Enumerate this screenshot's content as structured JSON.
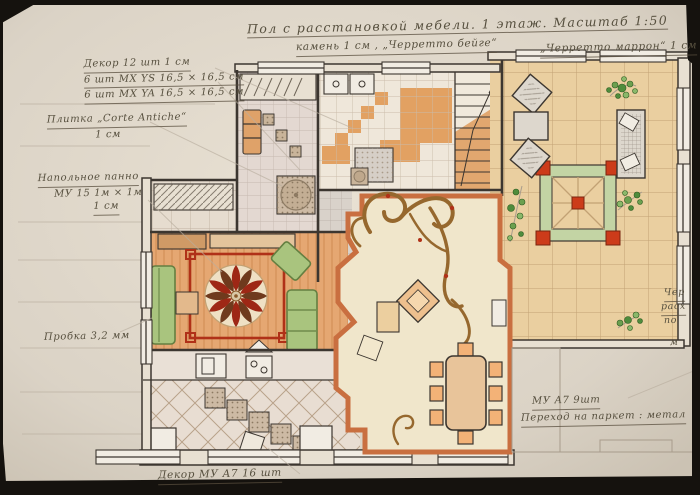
{
  "title": {
    "main": "Пол с расстановкой мебели. 1 этаж. Масштаб 1:50",
    "sub_left": "камень 1 см , „Черретто бейге“",
    "sub_right": "„Черретто маррон“ 1 см"
  },
  "notes": {
    "decor_line1": "Декор 12 шт   1 см",
    "decor_line2": "6 шт MX YS   16,5 × 16,5 см",
    "decor_line3": "6 шт MX YA   16,5 × 16,5 см",
    "tile_line1": "Плитка „Corte Antiche“",
    "tile_line2": "1 см",
    "panel_line1": "Напольное панно",
    "panel_line2": "МУ 15   1м × 1м",
    "panel_line3": "1 см",
    "cork": "Пробка 3,2 мм",
    "bottom_decor": "Декор МУ А7   16 шт",
    "right_count": "МУ А7   9шт",
    "right_transition": "Переход на паркет : метал",
    "edge_frag1": "Чер",
    "edge_frag2": "расх",
    "edge_frag3": "по",
    "edge_frag4": "м"
  },
  "colors": {
    "paper": "#d8d1c4",
    "paper-light": "#e8e0d2",
    "ink": "#3c3630",
    "pencil": "#a89c8c",
    "tan-floor": "#eacfa0",
    "tan-line": "#c2a274",
    "orange-floor": "#e5a772",
    "orange-deep": "#cf7a43",
    "terracotta": "#c96f40",
    "red": "#b03118",
    "dark-red": "#8c2414",
    "green": "#a9c47e",
    "green-dark": "#647f41",
    "leaf": "#4f8c3c",
    "cream": "#f0e6cb",
    "pale": "#e4d9d2",
    "gray-tile": "#d6cec6",
    "mosaic": "#b9a88f",
    "brown-swirl": "#96682e",
    "white-fix": "#f1ece3",
    "black-border": "#15120e",
    "note": "#57503f"
  }
}
